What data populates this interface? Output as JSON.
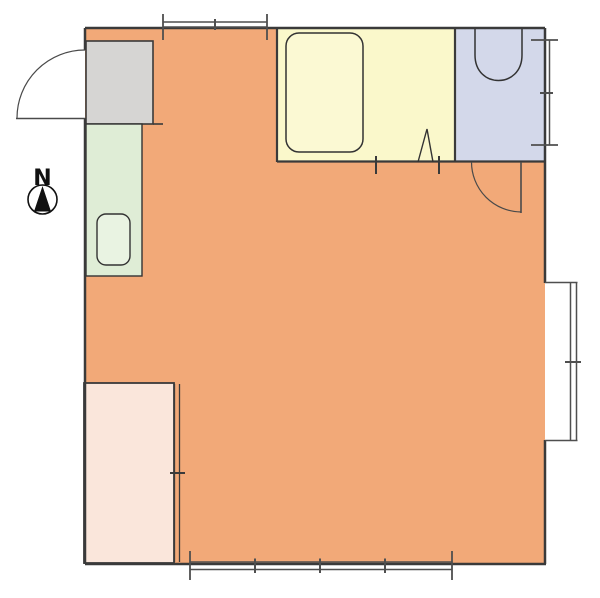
{
  "title": "apartment-floor-plan",
  "compass": {
    "label": "N"
  },
  "colors": {
    "background": "#ffffff",
    "wall": "#3a3a3a",
    "window": "#4f4f4f",
    "door": "#4a4a4a",
    "fixture_stroke": "#333333",
    "main_room": "#F2A978",
    "bathroom": "#FAF8CB",
    "toilet_room": "#D3D8EA",
    "kitchen": "#DFEDD6",
    "entrance": "#D6D5D3",
    "closet": "#FAE6DB",
    "bathtub": "#FBF9D3",
    "kitchen_sink": "#E9F3E2",
    "toilet_fill": "#D3D8EA",
    "compass_ink": "#111111",
    "compass_circle_fill": "#ffffff"
  },
  "rooms": [
    {
      "name": "main-room",
      "color_key": "main_room"
    },
    {
      "name": "bathroom",
      "color_key": "bathroom"
    },
    {
      "name": "toilet-room",
      "color_key": "toilet_room"
    },
    {
      "name": "kitchen-counter",
      "color_key": "kitchen"
    },
    {
      "name": "entrance",
      "color_key": "entrance"
    },
    {
      "name": "closet",
      "color_key": "closet"
    }
  ],
  "fixtures": [
    {
      "name": "bathtub"
    },
    {
      "name": "toilet"
    },
    {
      "name": "kitchen-sink"
    }
  ],
  "openings": [
    {
      "name": "entrance-door",
      "type": "swing"
    },
    {
      "name": "toilet-door",
      "type": "swing"
    },
    {
      "name": "bathroom-door",
      "type": "folding"
    },
    {
      "name": "top-wall-window",
      "type": "window"
    },
    {
      "name": "toilet-window",
      "type": "window"
    },
    {
      "name": "right-bay-window",
      "type": "window"
    },
    {
      "name": "bottom-window",
      "type": "window"
    },
    {
      "name": "closet-sliding-door",
      "type": "sliding"
    }
  ]
}
